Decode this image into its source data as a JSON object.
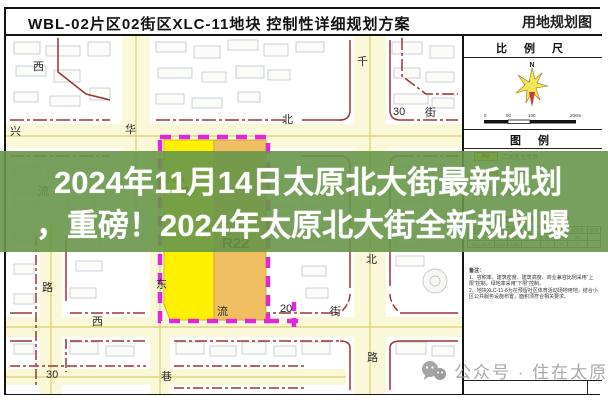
{
  "title_bar": {
    "left": "WBL-02片区02街区XLC-11地块 控制性详细规划方案",
    "right": "用地规划图"
  },
  "overlay": {
    "line1": "2024年11月14日太原北大街最新规划",
    "line2": "，重磅！2024年太原北大街全新规划曝"
  },
  "map": {
    "parcel_labels": [
      {
        "text": "XLC-11-1"
      },
      {
        "text": "R2"
      },
      {
        "text": "XLC-11-2"
      },
      {
        "text": "R22"
      }
    ],
    "road_labels": [
      {
        "text": "西"
      },
      {
        "text": "兴"
      },
      {
        "text": "华"
      },
      {
        "text": "北"
      },
      {
        "text": "30"
      },
      {
        "text": "街"
      },
      {
        "text": "千"
      },
      {
        "text": "流"
      },
      {
        "text": "路"
      },
      {
        "text": "东"
      },
      {
        "text": "西"
      },
      {
        "text": "流"
      },
      {
        "text": "20"
      },
      {
        "text": "街"
      },
      {
        "text": "北"
      },
      {
        "text": "路"
      },
      {
        "text": "30"
      },
      {
        "text": "巷"
      }
    ],
    "colors": {
      "parcel_yellow": "#ffef00",
      "parcel_orange": "#f0bf62",
      "boundary_magenta": "#e128d8",
      "road_line_red": "#9a3732"
    }
  },
  "sidebar": {
    "scale_title": "比 例 尺",
    "north": "N",
    "scale_ticks": [
      "0",
      "50",
      "100",
      "200m"
    ],
    "legend_title": "图 例",
    "legend": [
      {
        "code": "R2",
        "label": "二类居住用地"
      },
      {
        "code": "R22",
        "label": "中小学用地"
      },
      {
        "code": "",
        "label": "规划范围（已拆）"
      }
    ],
    "table": {
      "title": "规划用地一览表",
      "headers": [
        "地块编号",
        "用地",
        "面积",
        "容积率",
        "密度",
        "高度",
        "绿地率",
        "备注"
      ],
      "rows": [
        [
          "XLC-11-1",
          "R2",
          "2.14",
          "2.4",
          "30",
          "54",
          "35",
          ""
        ],
        [
          "XLC-11-2",
          "R22",
          "1.05",
          "—",
          "—",
          "—",
          "—",
          ""
        ]
      ]
    },
    "notes_title": "备注：",
    "notes": [
      "1、容积率、建筑密度、建筑高度、商业兼容比例采用“上限”控制，绿地率采用“下限”控制。",
      "2、地块XLC-11-6为在预留社区体育活动场地用地，结合小区公共服务设施布置，面积须符合相关要求。"
    ]
  },
  "watermark": {
    "text": "公众号 · 住在太原"
  }
}
